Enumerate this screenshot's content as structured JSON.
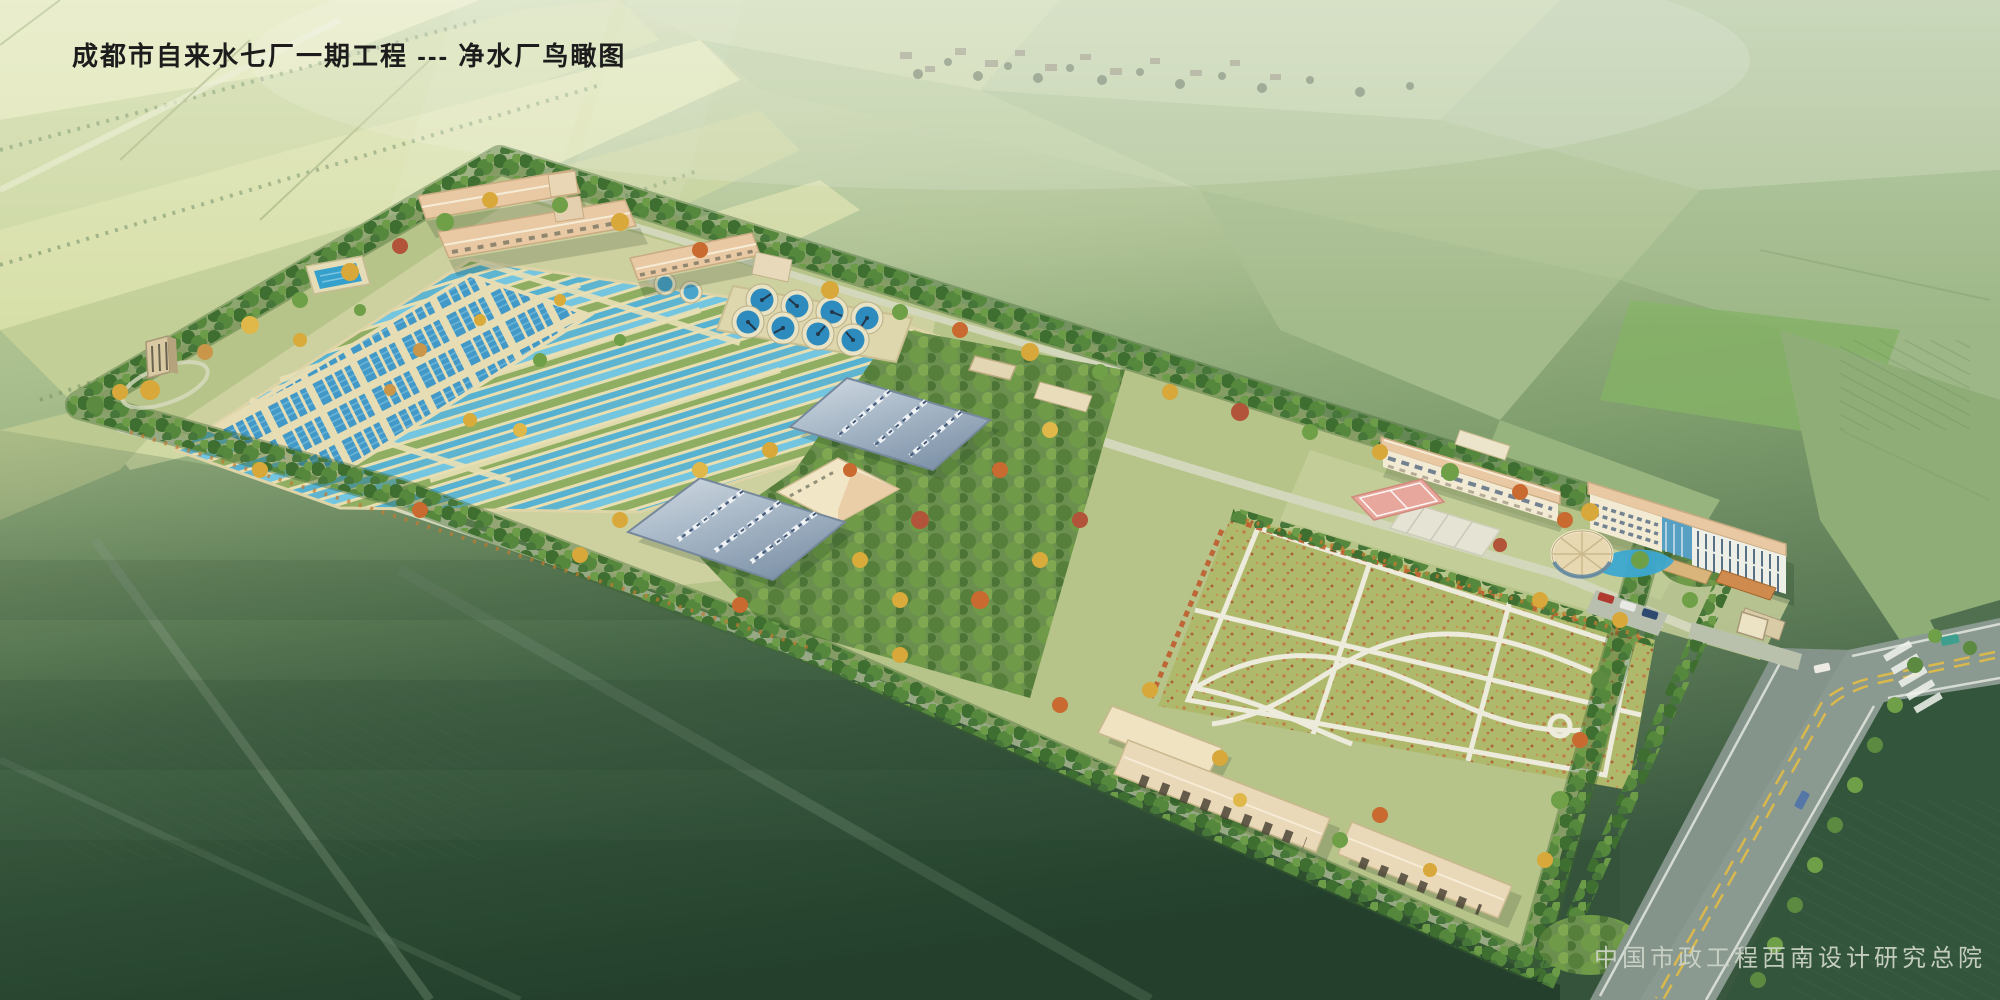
{
  "header": {
    "title": "成都市自来水七厂一期工程 --- 净水厂鸟瞰图"
  },
  "footer": {
    "credit": "中国市政工程西南设计研究总院"
  },
  "colors": {
    "title_color": "#1c1c1c",
    "credit_color": "#ccd3c6",
    "water": "#5fb5d0",
    "water_light": "#74c6e0",
    "water_deep": "#57b2d2",
    "planted_green": "#8fae62",
    "basin_wall": "#e7dfb2",
    "tank_blue": "#4298c6",
    "clarifier_water": "#2e8bbd",
    "lawn_green": "#aeb96c",
    "orchard_green": "#6b8f4f",
    "tree_dark": "#3e6e30",
    "road_asphalt": "#8a9a90",
    "centerline_yellow": "#d9b84e",
    "court_pink": "#e8a79c",
    "ground_tan": "#cfd2a2",
    "site_grass": "#b6c389",
    "roof_blue": "#9eb0c2",
    "roof_tan": "#e8c9a4",
    "wall_cream": "#f2ead2",
    "field_light": "#d6dfa6"
  }
}
